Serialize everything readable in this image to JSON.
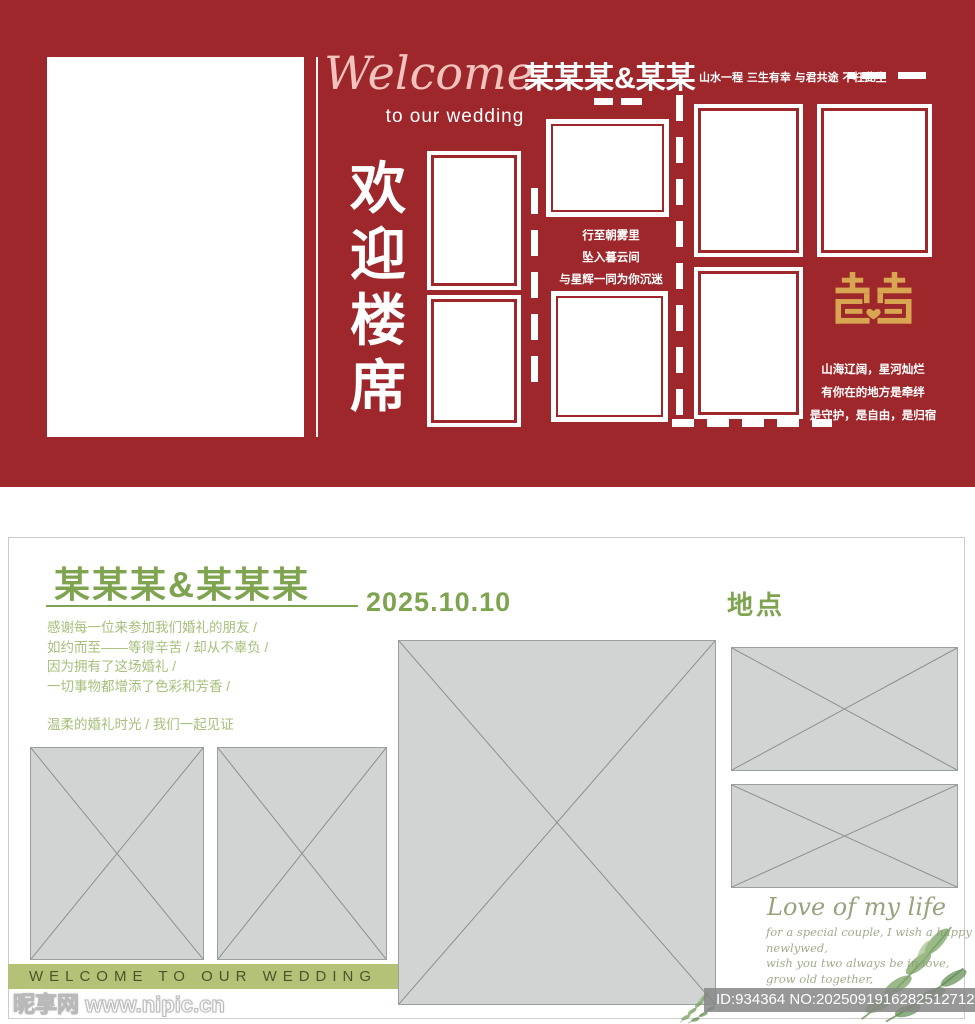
{
  "colors": {
    "panel_red": "#9e272c",
    "gold": "#d8a550",
    "green_heading": "#7fa450",
    "green_body": "#a6bf7a",
    "olive_bar": "#b3c277"
  },
  "red_panel": {
    "welcome_script": "Welcome",
    "welcome_sub": "to our wedding",
    "couple_names": "某某某&某某",
    "motto": "山水一程  三生有幸  与君共途  不枉此生",
    "vertical_title": [
      "欢",
      "迎",
      "楼",
      "席"
    ],
    "poem_lines": [
      "行至朝雾里",
      "坠入暮云间",
      "与星辉一同为你沉迷"
    ],
    "double_happiness_symbol": "囍",
    "blessing_lines": [
      "山海辽阔，星河灿烂",
      "有你在的地方是牵绊",
      "是守护，是自由，是归宿"
    ]
  },
  "white_panel": {
    "couple_names": "某某某&某某某",
    "date": "2025.10.10",
    "location_label": "地点",
    "paragraph_lines": [
      "感谢每一位来参加我们婚礼的朋友 /",
      "如约而至——等得辛苦 / 却从不辜负 /",
      "因为拥有了这场婚礼 /",
      "一切事物都增添了色彩和芳香 /"
    ],
    "witness_line": "温柔的婚礼时光 / 我们一起见证",
    "banner_text": "WELCOME TO OUR WEDDING",
    "love_title": "Love of my life",
    "love_lines": [
      "for a special couple, I wish a happy",
      "newlywed,",
      "wish you two always be in love,",
      "grow old together,"
    ]
  },
  "watermark": {
    "site_name_and_url": "昵享网 www.nipic.cn",
    "stock_id": "ID:934364 NO:20250919162825127125"
  }
}
